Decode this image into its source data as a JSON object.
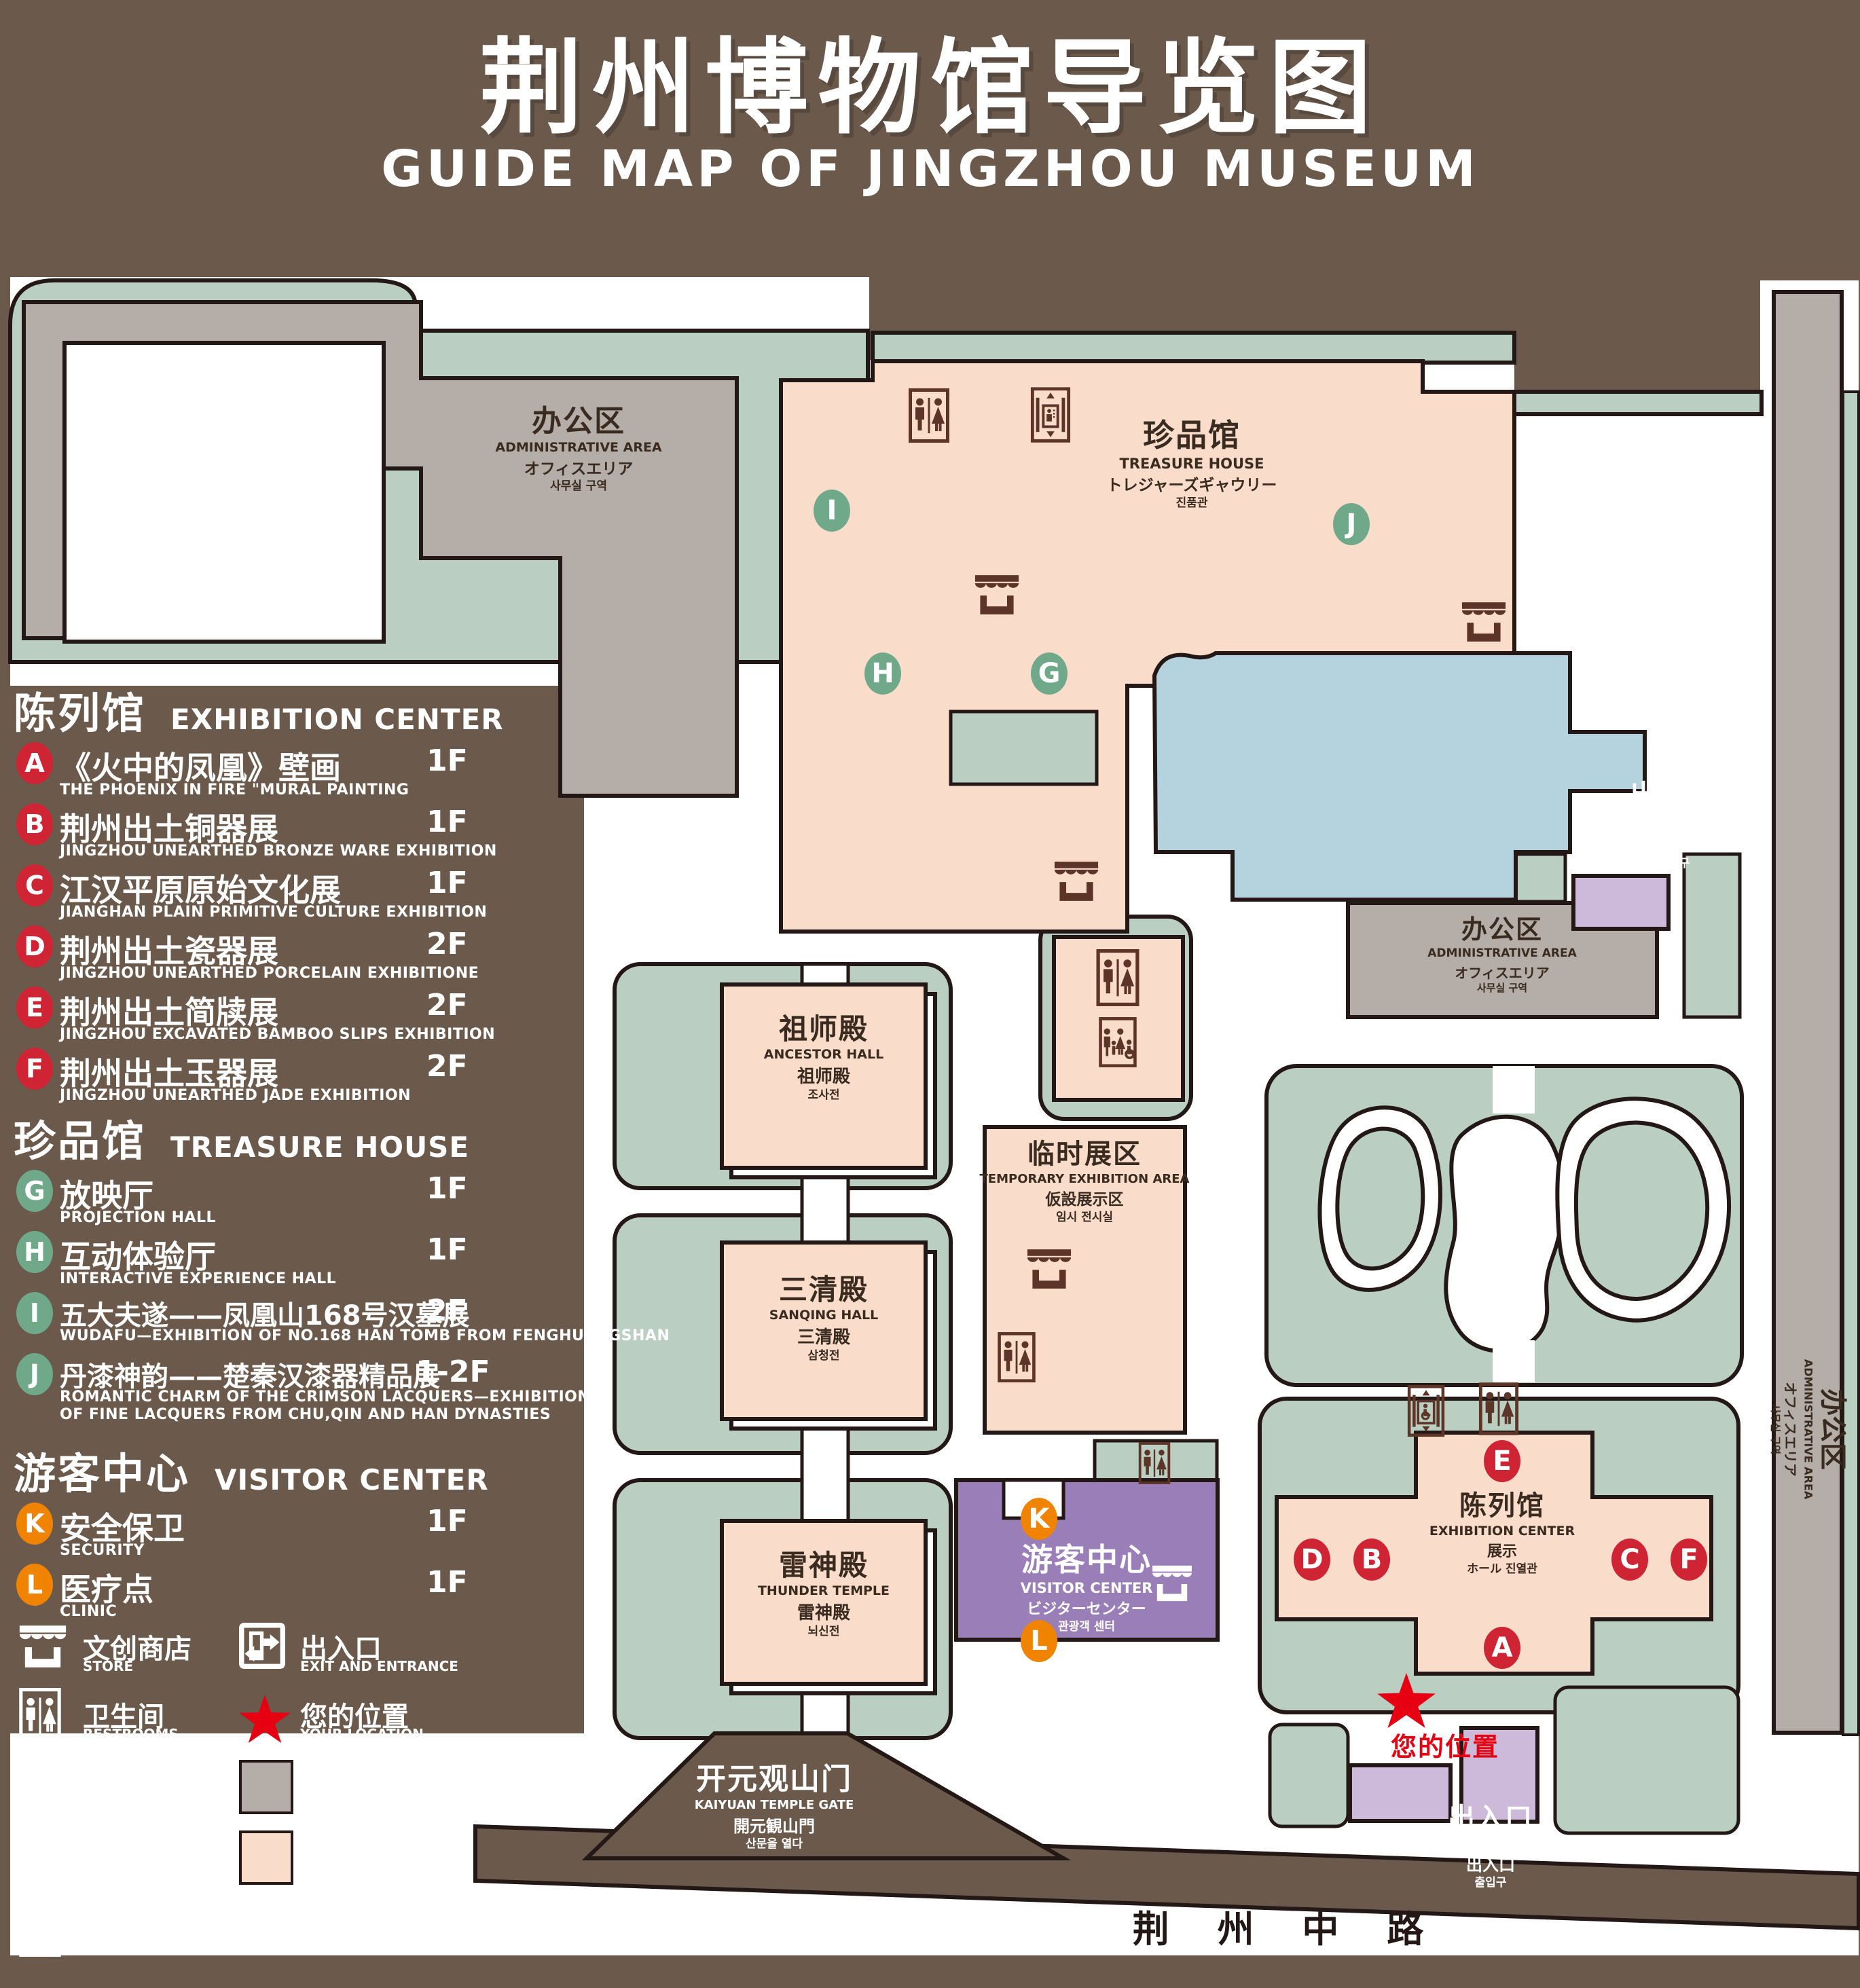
{
  "title": {
    "cn": "荆州博物馆导览图",
    "en": "GUIDE MAP OF JINGZHOU MUSEUM"
  },
  "legend": {
    "sections": [
      {
        "cn": "陈列馆",
        "en": "EXHIBITION CENTER",
        "items": [
          {
            "id": "A",
            "cn": "《火中的凤凰》壁画",
            "en": "THE PHOENIX IN FIRE \"MURAL PAINTING",
            "floor": "1F"
          },
          {
            "id": "B",
            "cn": "荆州出土铜器展",
            "en": "JINGZHOU UNEARTHED BRONZE WARE EXHIBITION",
            "floor": "1F"
          },
          {
            "id": "C",
            "cn": "江汉平原原始文化展",
            "en": "JIANGHAN PLAIN PRIMITIVE CULTURE EXHIBITION",
            "floor": "1F"
          },
          {
            "id": "D",
            "cn": "荆州出土瓷器展",
            "en": "JINGZHOU UNEARTHED PORCELAIN EXHIBITIONE",
            "floor": "2F"
          },
          {
            "id": "E",
            "cn": "荆州出土简牍展",
            "en": "JINGZHOU EXCAVATED BAMBOO SLIPS EXHIBITION",
            "floor": "2F"
          },
          {
            "id": "F",
            "cn": "荆州出土玉器展",
            "en": "JINGZHOU UNEARTHED JADE EXHIBITION",
            "floor": "2F"
          }
        ]
      },
      {
        "cn": "珍品馆",
        "en": "TREASURE HOUSE",
        "items": [
          {
            "id": "G",
            "cn": "放映厅",
            "en": "PROJECTION HALL",
            "floor": "1F"
          },
          {
            "id": "H",
            "cn": "互动体验厅",
            "en": "INTERACTIVE EXPERIENCE HALL",
            "floor": "1F"
          },
          {
            "id": "I",
            "cn": "五大夫遂——凤凰山168号汉墓展",
            "en": "WUDAFU—EXHIBITION OF NO.168 HAN TOMB FROM FENGHUANGSHAN",
            "floor": "2F"
          },
          {
            "id": "J",
            "cn": "丹漆神韵——楚秦汉漆器精品展",
            "en": "ROMANTIC CHARM OF THE CRIMSON LACQUERS—EXHIBITIONS",
            "en2": "OF FINE LACQUERS FROM CHU,QIN AND HAN DYNASTIES",
            "floor": "1-2F"
          }
        ]
      },
      {
        "cn": "游客中心",
        "en": "VISITOR CENTER",
        "items": [
          {
            "id": "K",
            "cn": "安全保卫",
            "en": "SECURITY",
            "floor": "1F"
          },
          {
            "id": "L",
            "cn": "医疗点",
            "en": "CLINIC",
            "floor": "1F"
          }
        ]
      }
    ],
    "icons": [
      {
        "icon": "store-icon",
        "cn": "文创商店",
        "en": "STORE"
      },
      {
        "icon": "exit-icon",
        "cn": "出入口",
        "en": "EXIT AND ENTRANCE"
      },
      {
        "icon": "restrooms-icon",
        "cn": "卫生间",
        "en": "RESTROOMS"
      },
      {
        "icon": "location-star-icon",
        "cn": "您的位置",
        "en": "YOUR LOCATION"
      },
      {
        "icon": "family-restrooms-icon",
        "cn": "家庭卫生间",
        "en": "FAMILY RESTROOMS"
      },
      {
        "icon": "office-area-swatch",
        "cn": "办公区域",
        "en": "OFFICE AREA"
      },
      {
        "icon": "accessible-elevator-icon",
        "cn": "无障碍电梯",
        "en": "ACCESSIBLE ELEVATOR"
      },
      {
        "icon": "display-area-swatch",
        "cn": "展示区域",
        "en": "DISPLAY AREA"
      },
      {
        "icon": "elevator-icon",
        "cn": "电梯",
        "en": "Elevator"
      }
    ]
  },
  "map": {
    "labels": {
      "admin_top": {
        "cn": "办公区",
        "en": "ADMINISTRATIVE AREA",
        "jp": "オフィスエリア",
        "kr": "사무실 구역"
      },
      "treasure_house": {
        "cn": "珍品馆",
        "en": "TREASURE HOUSE",
        "jp": "トレジャーズギャウリー",
        "kr": "진품관"
      },
      "exit_east": {
        "cn": "出入口",
        "en": "EXIT AND ENTRANCE",
        "cn2": "出入口",
        "kr": "출입구"
      },
      "admin_mid": {
        "cn": "办公区",
        "en": "ADMINISTRATIVE AREA",
        "jp": "オフィスエリア",
        "kr": "사무실 구역"
      },
      "ancestor_hall": {
        "cn": "祖师殿",
        "en": "ANCESTOR HALL",
        "jp": "祖师殿",
        "kr": "조사전"
      },
      "temporary_area": {
        "cn": "临时展区",
        "en": "TEMPORARY EXHIBITION AREA",
        "jp": "仮設展示区",
        "kr": "임시 전시실"
      },
      "sanqing_hall": {
        "cn": "三清殿",
        "en": "SANQING HALL",
        "jp": "三清殿",
        "kr": "삼청전"
      },
      "thunder_temple": {
        "cn": "雷神殿",
        "en": "THUNDER TEMPLE",
        "jp": "雷神殿",
        "kr": "뇌신전"
      },
      "visitor_center": {
        "cn": "游客中心",
        "en": "VISITOR CENTER",
        "jp": "ビジターセンター",
        "kr": "관광객 센터"
      },
      "exhibition_center": {
        "cn": "陈列馆",
        "en": "EXHIBITION CENTER",
        "jp": "展示",
        "kr": "ホール 진열관"
      },
      "your_location": {
        "cn": "您的位置"
      },
      "gate": {
        "cn": "开元观山门",
        "en": "KAIYUAN TEMPLE GATE",
        "jp": "開元観山門",
        "kr": "산문을 열다"
      },
      "road": {
        "cn": "荆 州 中 路"
      },
      "admin_right": {
        "cn": "办公区",
        "en": "ADMINISTRATIVE AREA",
        "jp": "オフィスエリア",
        "kr": "사무실 구역"
      },
      "exit_south": {
        "cn": "出入口",
        "en": "EXIT AND ENTRANCE",
        "cn2": "出入口",
        "kr": "출입구"
      }
    },
    "markers": [
      {
        "id": "A",
        "color": "red"
      },
      {
        "id": "B",
        "color": "red"
      },
      {
        "id": "C",
        "color": "red"
      },
      {
        "id": "D",
        "color": "red"
      },
      {
        "id": "E",
        "color": "red"
      },
      {
        "id": "F",
        "color": "red"
      },
      {
        "id": "G",
        "color": "green"
      },
      {
        "id": "H",
        "color": "green"
      },
      {
        "id": "I",
        "color": "green"
      },
      {
        "id": "J",
        "color": "green"
      },
      {
        "id": "K",
        "color": "orange"
      },
      {
        "id": "L",
        "color": "orange"
      }
    ]
  },
  "colors": {
    "background": "#6B5A4C",
    "lawn_green": "#BACFC2",
    "display_pink": "#F9DCCA",
    "office_gray": "#B5ADA8",
    "pond_blue": "#B5D2DF",
    "visitor_purple": "#9A7EB7",
    "light_purple": "#CDB9DA",
    "icon_brown": "#5C3528",
    "marker_red": "#CF2433",
    "marker_green": "#6FA98A",
    "marker_orange": "#F08300",
    "location_red": "#E60012",
    "outline_black": "#231815"
  }
}
